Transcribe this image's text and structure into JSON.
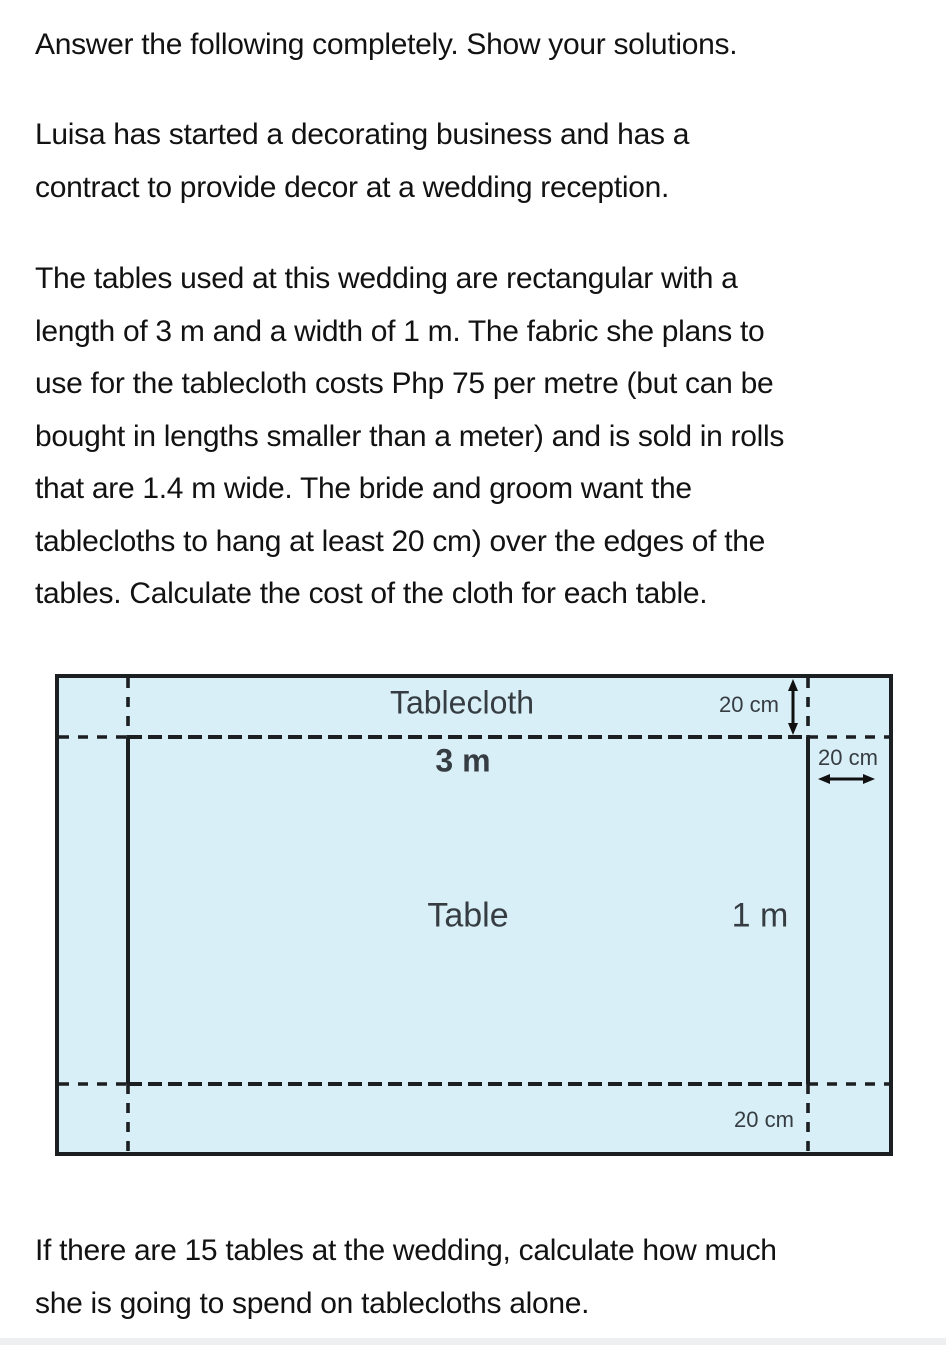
{
  "problem": {
    "instruction": "Answer the following completely. Show your solutions.",
    "intro": "Luisa has started a decorating business and has a\ncontract to provide decor at a wedding reception.",
    "details": "The tables used at this wedding are rectangular with a\nlength of 3 m and a width of 1 m. The fabric she plans to\nuse for the tablecloth costs Php 75 per metre (but can be\nbought in lengths smaller than a meter) and is sold in rolls\nthat are 1.4 m wide. The bride and groom want the\ntablecloths to hang at least 20 cm) over the edges of the\ntables. Calculate the cost of the cloth for each table.",
    "followup": "If there are 15 tables at the wedding, calculate how much\nshe is going to spend on tablecloths alone."
  },
  "diagram": {
    "tablecloth_label": "Tablecloth",
    "table_label": "Table",
    "length_label": "3 m",
    "width_label": "1 m",
    "overhang_top_label": "20 cm",
    "overhang_right_label": "20 cm",
    "overhang_bottom_label": "20 cm",
    "fill_color": "#d9eff7",
    "line_color": "#1b1f21",
    "text_color": "#363d42"
  }
}
